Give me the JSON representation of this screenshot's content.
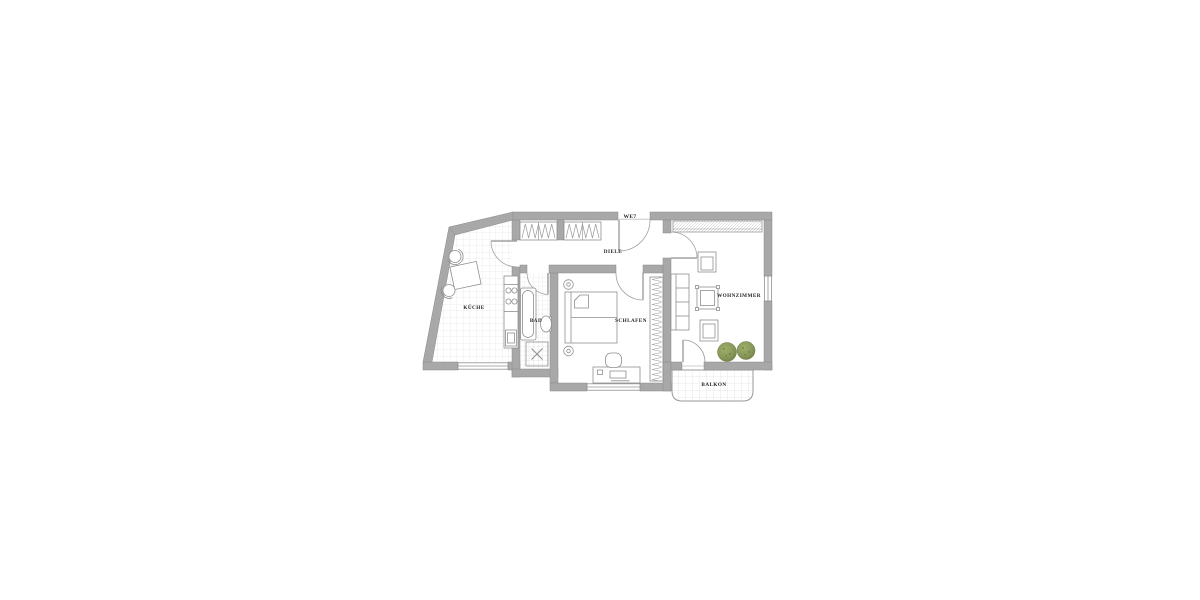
{
  "floor_plan": {
    "unit_label": "WE7",
    "rooms": [
      {
        "id": "kueche",
        "label": "KÜCHE"
      },
      {
        "id": "bad",
        "label": "BAD"
      },
      {
        "id": "diele",
        "label": "DIELE"
      },
      {
        "id": "schlafen",
        "label": "SCHLAFEN"
      },
      {
        "id": "wohnzimmer",
        "label": "WOHNZIMMER"
      },
      {
        "id": "balkon",
        "label": "BALKON"
      }
    ],
    "colors": {
      "background": "#ffffff",
      "wall_fill": "#a8a8a8",
      "wall_edge": "#8b8b8b",
      "furniture_line": "#8f8f8f",
      "door_arc": "#a0a0a0",
      "tile_line": "#dcdcdc",
      "plant_green": "#87985a",
      "label_text": "#232323"
    }
  }
}
